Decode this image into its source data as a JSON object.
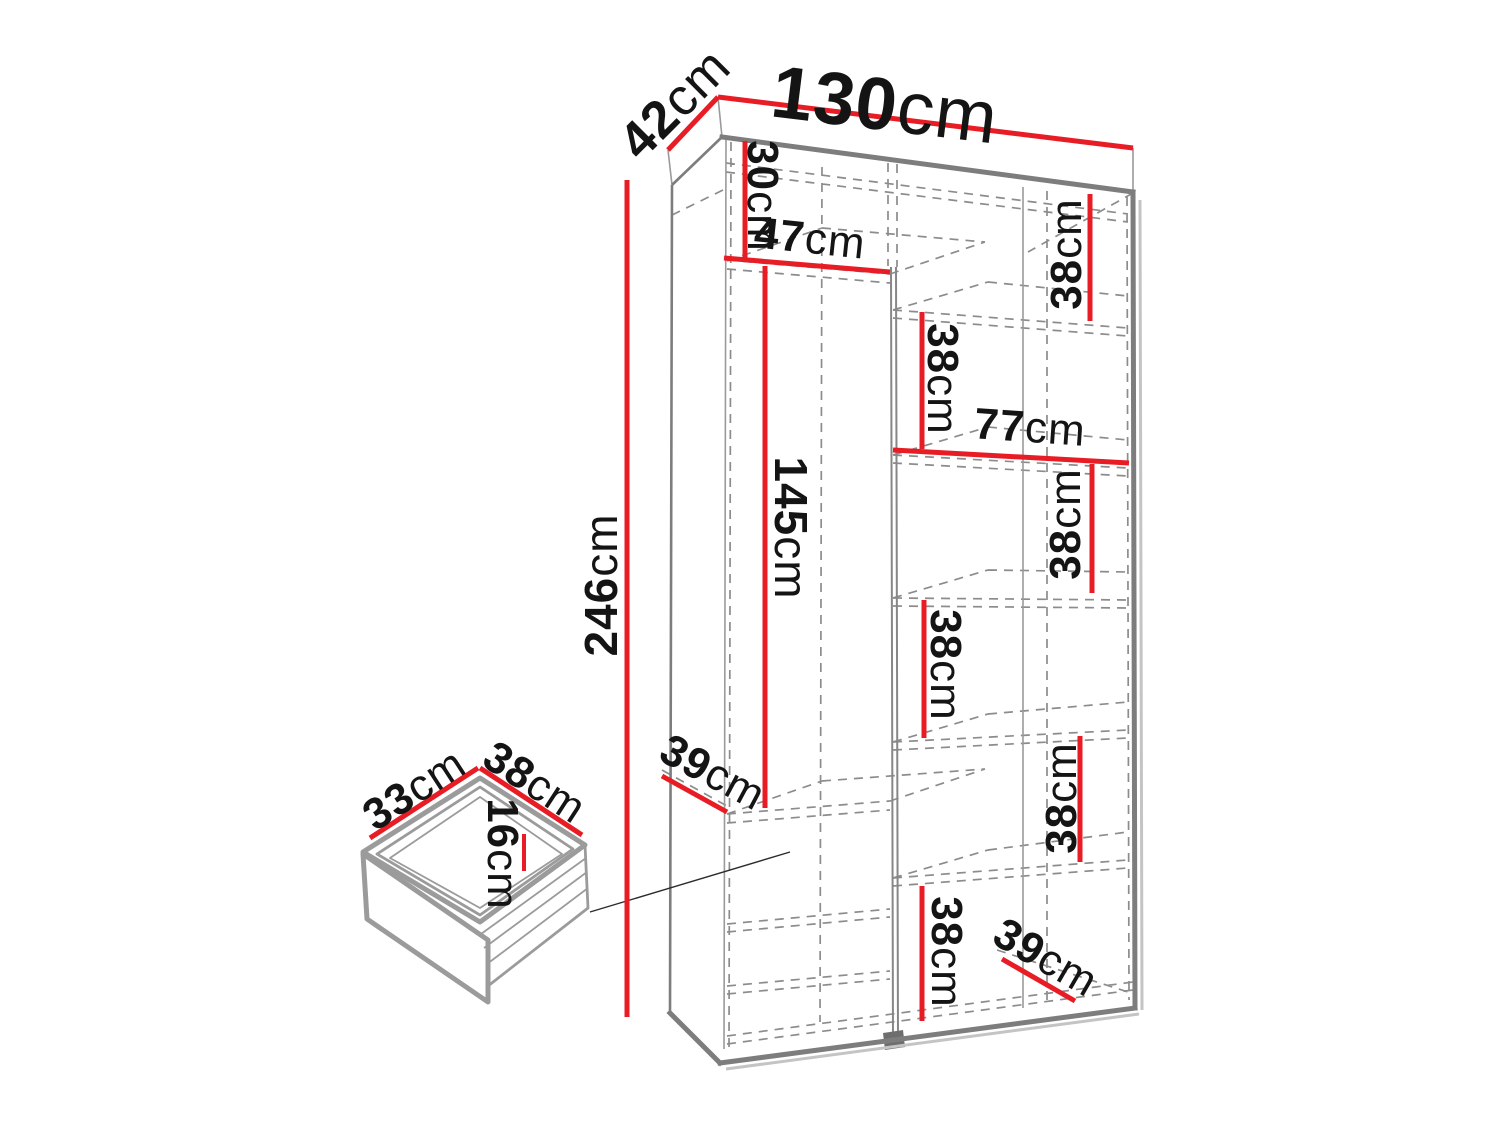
{
  "diagram": {
    "kind": "furniture-dimension-diagram",
    "subject": "wardrobe-interior-with-drawer-detail",
    "unit": "cm",
    "colors": {
      "dimension_red": "#e81c24",
      "outline_gray": "#7d7d7d",
      "dash_gray": "#8c8c8c",
      "text_black": "#141414",
      "shadow_gray": "#c4c4c4",
      "drawer_gray": "#9b9b9b"
    },
    "labels": {
      "total_width": {
        "value": "130",
        "unit": "cm"
      },
      "total_depth": {
        "value": "42",
        "unit": "cm"
      },
      "total_height": {
        "value": "246",
        "unit": "cm"
      },
      "top_section_height": {
        "value": "30",
        "unit": "cm"
      },
      "left_column_width": {
        "value": "47",
        "unit": "cm"
      },
      "hanging_height": {
        "value": "145",
        "unit": "cm"
      },
      "right_section_width": {
        "value": "77",
        "unit": "cm"
      },
      "shelf_gap_top_right": {
        "value": "38",
        "unit": "cm"
      },
      "shelf_gap_upper_mid": {
        "value": "38",
        "unit": "cm"
      },
      "shelf_gap_upper_rt": {
        "value": "38",
        "unit": "cm"
      },
      "shelf_gap_middle": {
        "value": "38",
        "unit": "cm"
      },
      "shelf_gap_lower_rt": {
        "value": "38",
        "unit": "cm"
      },
      "shelf_gap_bottom": {
        "value": "38",
        "unit": "cm"
      },
      "left_shelf_depth": {
        "value": "39",
        "unit": "cm"
      },
      "right_shelf_depth": {
        "value": "39",
        "unit": "cm"
      },
      "drawer_side_depth": {
        "value": "33",
        "unit": "cm"
      },
      "drawer_front_width": {
        "value": "38",
        "unit": "cm"
      },
      "drawer_height": {
        "value": "16",
        "unit": "cm"
      }
    }
  }
}
